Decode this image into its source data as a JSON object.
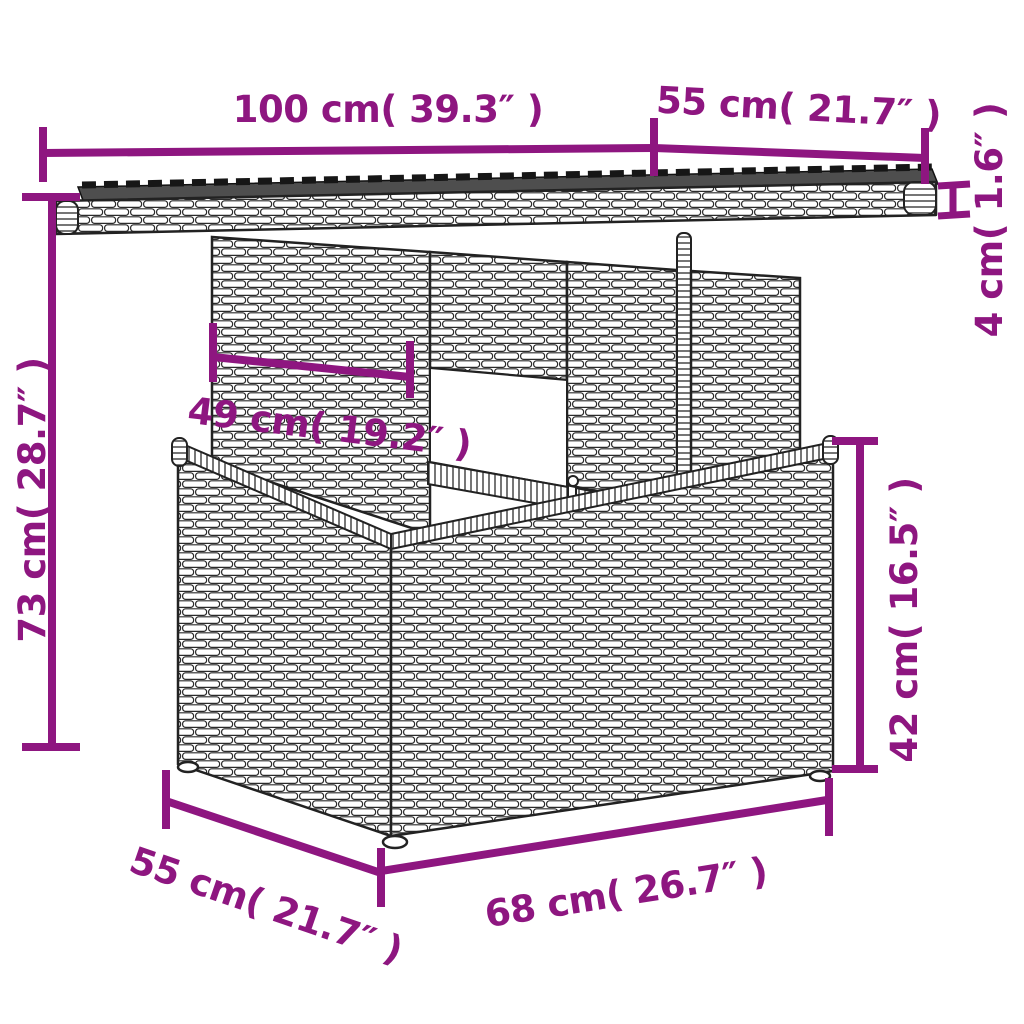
{
  "labels": {
    "top_width": "100 cm( 39.3″ )",
    "top_depth": "55 cm( 21.7″ )",
    "top_thickness": "4 cm( 1.6″ )",
    "total_height": "73 cm( 28.7″ )",
    "shelf_width": "49 cm( 19.2″ )",
    "base_height": "42 cm( 16.5″ )",
    "base_depth": "55 cm( 21.7″ )",
    "base_width": "68 cm( 26.7″ )"
  },
  "colors": {
    "dimension": "#8e1680",
    "outline": "#222222",
    "glass": "#4e4e4e",
    "background": "#ffffff"
  }
}
